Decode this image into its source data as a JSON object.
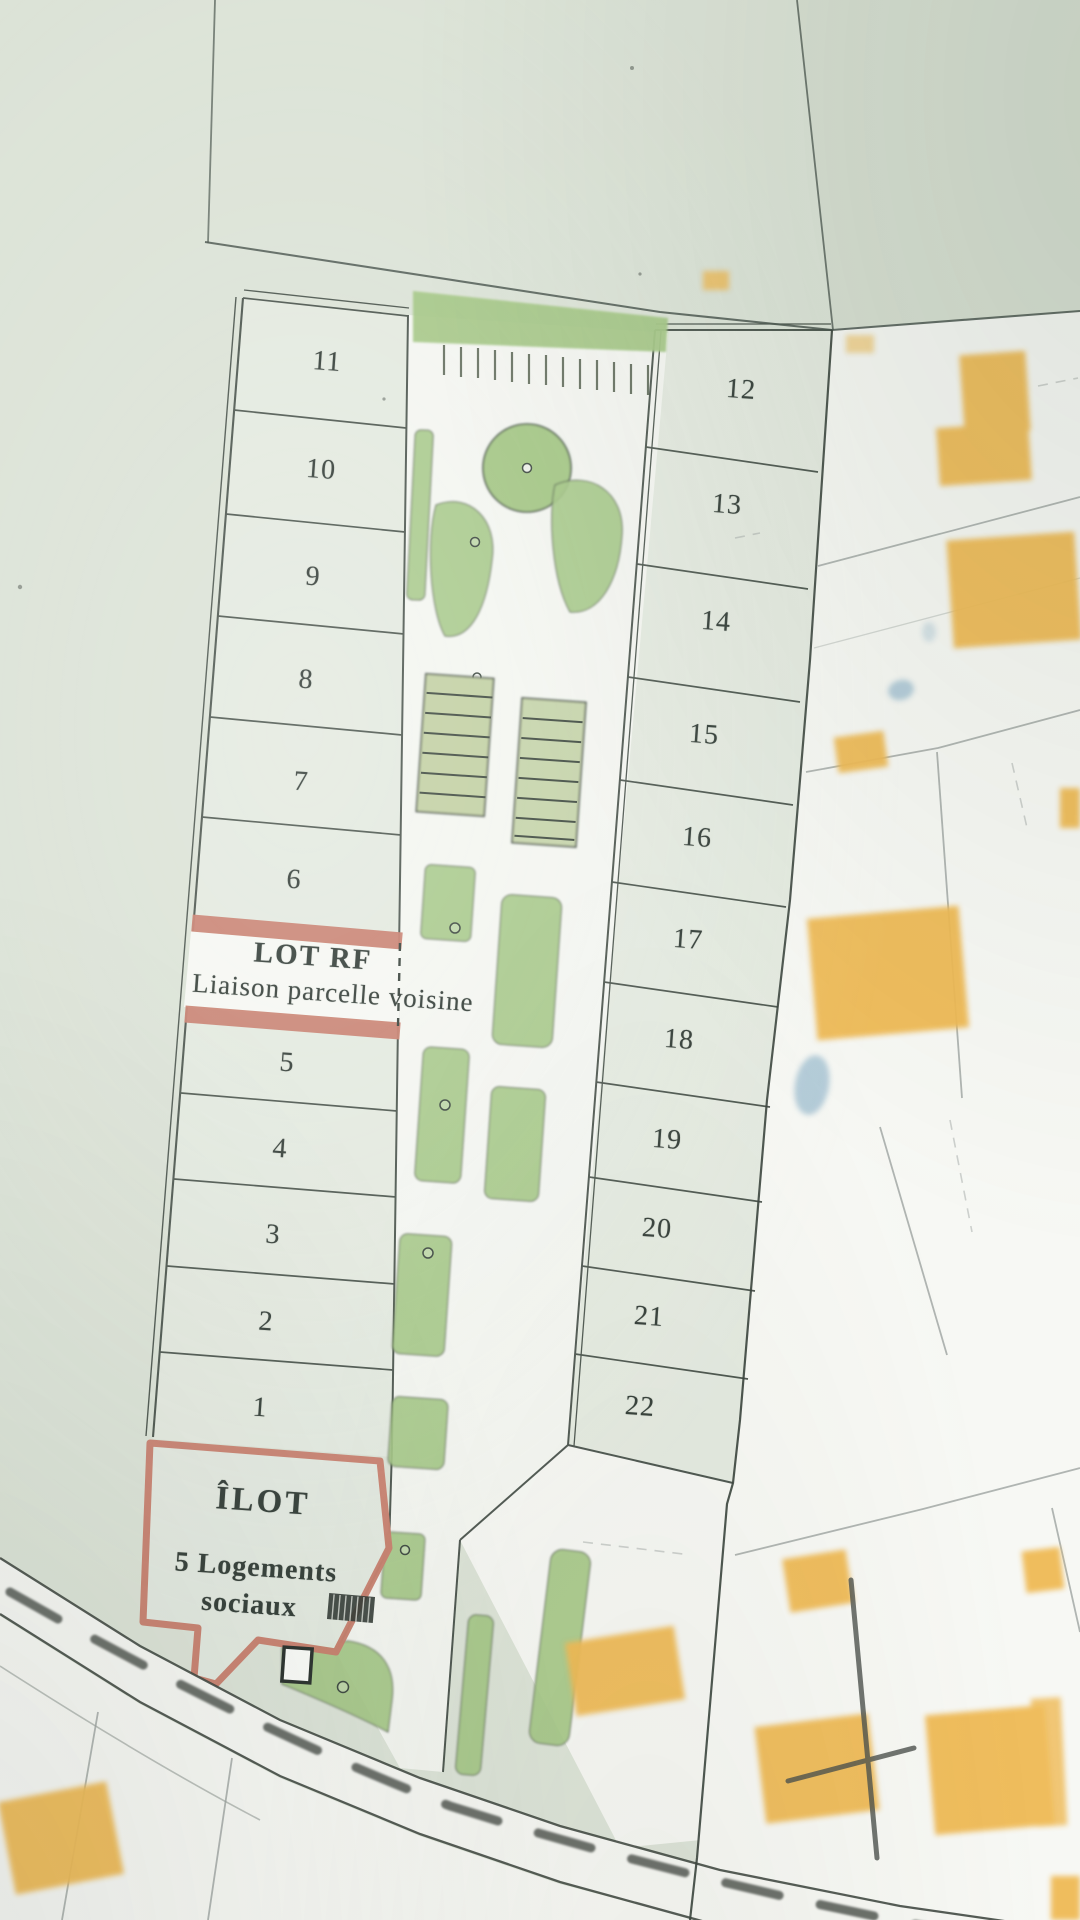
{
  "plan": {
    "left_lots": [
      "11",
      "10",
      "9",
      "8",
      "7",
      "6",
      "5",
      "4",
      "3",
      "2",
      "1"
    ],
    "right_lots": [
      "12",
      "13",
      "14",
      "15",
      "16",
      "17",
      "18",
      "19",
      "20",
      "21",
      "22"
    ],
    "lot_rf": {
      "title": "LOT RF",
      "subtitle": "Liaison parcelle voisine"
    },
    "ilot": {
      "title": "ÎLOT",
      "line1": "5 Logements",
      "line2": "sociaux"
    },
    "colors": {
      "background_green": "#dce3d7",
      "lot_green": "#e4eae0",
      "landscape_green": "#a5c786",
      "outline_red": "#c9806f",
      "house_orange": "#efba55",
      "pool_blue": "#a8c4d4",
      "parcel_white": "#f7f8f4",
      "line_dark": "#39433c",
      "line_gray": "#989f9c"
    }
  }
}
